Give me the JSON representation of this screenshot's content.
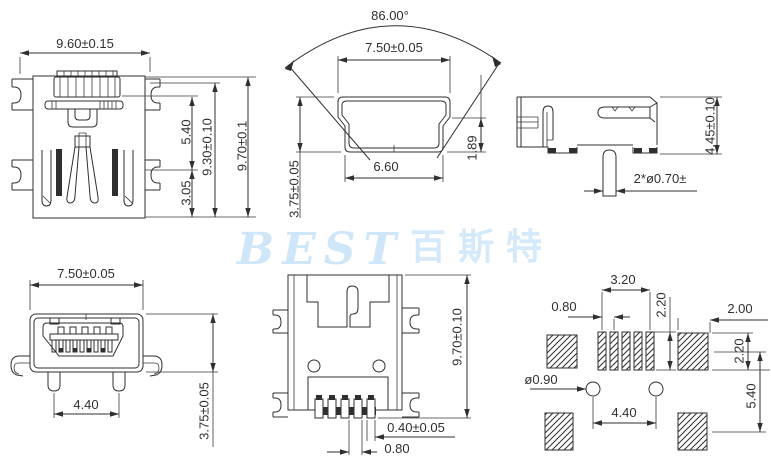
{
  "watermark": {
    "latin": "BEST",
    "cjk": "百斯特",
    "color": "#cfe6f8"
  },
  "views": {
    "front_top": {
      "width": "9.60±0.15",
      "slot_h": "5.40",
      "lower_h": "3.05",
      "inner_h": "9.30±0.10",
      "overall_h": "9.70±0.1"
    },
    "section": {
      "angle": "86.00°",
      "top_width": "7.50±0.05",
      "bottom_width": "6.60",
      "lip": "1.89",
      "height": "3.75±0.05"
    },
    "side": {
      "height": "4.45±0.10",
      "pin": "2*ø0.70±"
    },
    "front_bottom": {
      "width": "7.50±0.05",
      "span": "4.40",
      "height": "3.75±0.05"
    },
    "bottom": {
      "height": "9.70±0.10",
      "pin_width": "0.40±0.05",
      "pitch": "0.80"
    },
    "pcb": {
      "group_width": "3.20",
      "pitch": "0.80",
      "pad_height": "2.20",
      "pad_width": "2.00",
      "pad_height2": "2.20",
      "row_span": "5.40",
      "hole": "ø0.90",
      "hole_span": "4.40"
    }
  }
}
